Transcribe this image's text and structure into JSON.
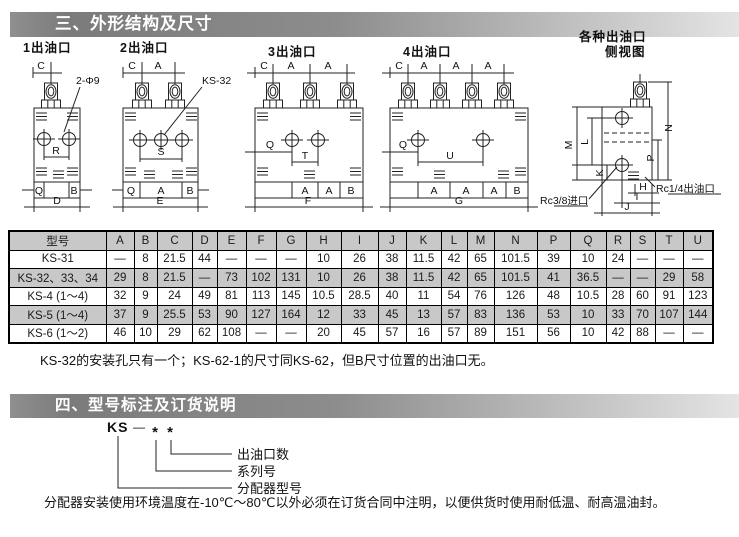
{
  "section3": {
    "bar_title": "三、外形结构及尺寸"
  },
  "drawings": {
    "d1": {
      "title": "1出油口",
      "callout": "2-Φ9",
      "top": [
        "C"
      ],
      "mid": "R",
      "band": [
        "Q",
        "B"
      ],
      "overall": "D"
    },
    "d2": {
      "title": "2出油口",
      "callout": "KS-32",
      "top": [
        "C",
        "A"
      ],
      "mid": "S",
      "band": [
        "Q",
        "A",
        "B"
      ],
      "overall": "E"
    },
    "d3": {
      "title": "3出油口",
      "top": [
        "C",
        "A",
        "A"
      ],
      "q": "Q",
      "mid": "T",
      "band": [
        "A",
        "A",
        "B"
      ],
      "overall": "F"
    },
    "d4": {
      "title": "4出油口",
      "top": [
        "C",
        "A",
        "A",
        "A"
      ],
      "q": "Q",
      "mid": "U",
      "band": [
        "A",
        "A",
        "A",
        "B"
      ],
      "overall": "G"
    },
    "side": {
      "title1": "各种出油口",
      "title2": "侧视图",
      "m": "M",
      "l": "L",
      "k": "K",
      "n": "N",
      "p": "P",
      "h": "H",
      "i": "I",
      "j": "J",
      "inlet": "Rc3/8进口",
      "outlet": "Rc1/4出油口"
    }
  },
  "table": {
    "headers": [
      "型号",
      "A",
      "B",
      "C",
      "D",
      "E",
      "F",
      "G",
      "H",
      "I",
      "J",
      "K",
      "L",
      "M",
      "N",
      "P",
      "Q",
      "R",
      "S",
      "T",
      "U"
    ],
    "rows": [
      {
        "model": "KS-31",
        "values": [
          "—",
          "8",
          "21.5",
          "44",
          "—",
          "—",
          "—",
          "10",
          "26",
          "38",
          "11.5",
          "42",
          "65",
          "101.5",
          "39",
          "10",
          "24",
          "—",
          "—",
          "—"
        ]
      },
      {
        "model": "KS-32、33、34",
        "values": [
          "29",
          "8",
          "21.5",
          "—",
          "73",
          "102",
          "131",
          "10",
          "26",
          "38",
          "11.5",
          "42",
          "65",
          "101.5",
          "41",
          "36.5",
          "—",
          "—",
          "29",
          "58"
        ]
      },
      {
        "model": "KS-4 (1～4)",
        "values": [
          "32",
          "9",
          "24",
          "49",
          "81",
          "113",
          "145",
          "10.5",
          "28.5",
          "40",
          "11",
          "54",
          "76",
          "126",
          "48",
          "10.5",
          "28",
          "60",
          "91",
          "123"
        ]
      },
      {
        "model": "KS-5 (1～4)",
        "values": [
          "37",
          "9",
          "25.5",
          "53",
          "90",
          "127",
          "164",
          "12",
          "33",
          "45",
          "13",
          "57",
          "83",
          "136",
          "53",
          "10",
          "33",
          "70",
          "107",
          "144"
        ]
      },
      {
        "model": "KS-6 (1～2)",
        "values": [
          "46",
          "10",
          "29",
          "62",
          "108",
          "—",
          "—",
          "20",
          "45",
          "57",
          "16",
          "57",
          "89",
          "151",
          "56",
          "10",
          "42",
          "88",
          "—",
          "—"
        ]
      }
    ],
    "note": "KS-32的安装孔只有一个；KS-62-1的尺寸同KS-62，但B尺寸位置的出油口无。"
  },
  "section4": {
    "bar_title": "四、型号标注及订货说明",
    "code": {
      "prefix": "KS",
      "dash": "—",
      "stars": [
        "*",
        "*"
      ],
      "labels": [
        "出油口数",
        "系列号",
        "分配器型号"
      ]
    },
    "note": "分配器安装使用环境温度在-10℃～80℃以外必须在订货合同中注明，以便供货时使用耐低温、耐高温油封。"
  },
  "colors": {
    "stripe": "#c8c8c8",
    "bar_dark": "#7b7b7b",
    "bar_light": "#e4e4e4",
    "ink": "#1a1a1a"
  }
}
